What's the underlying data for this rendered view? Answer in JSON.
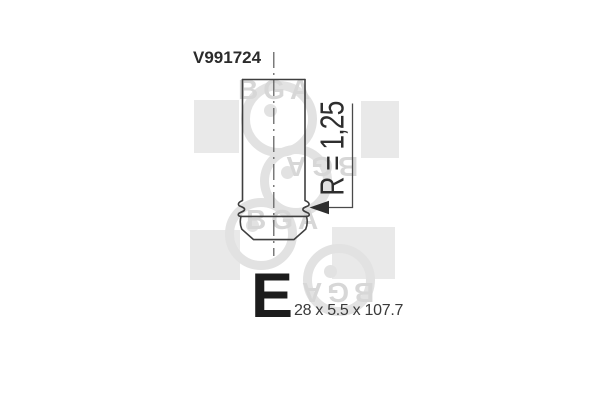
{
  "part": {
    "number": "V991724",
    "type_code": "E",
    "dimensions": "28 x 5.5 x 107.7",
    "radius_annotation": "R = 1,25"
  },
  "watermark": {
    "brand": "BGA",
    "color": "#dedede"
  },
  "colors": {
    "line": "#3f3f3f",
    "centerline": "#5a5a5a",
    "text": "#2e2e2e",
    "background": "#ffffff"
  }
}
